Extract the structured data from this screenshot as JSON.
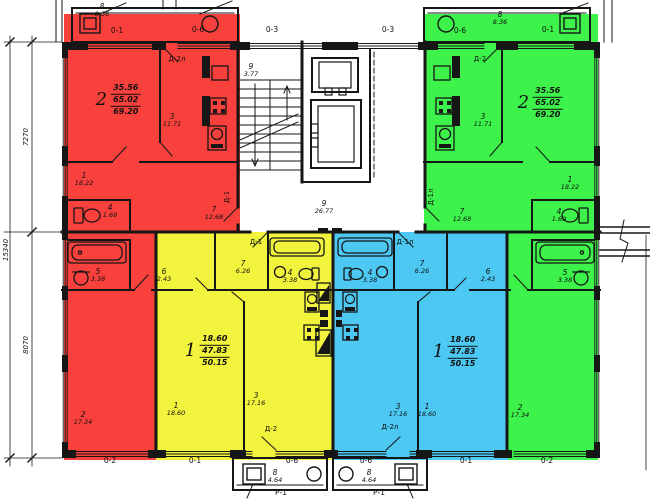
{
  "colors": {
    "red": "#f8403c",
    "yellow": "#f1f33c",
    "blue": "#4cc8f2",
    "green": "#3df24a"
  },
  "apartments": [
    {
      "id": "apartment-2-left",
      "highlight": "red",
      "number": "2",
      "living_area": "35.56",
      "total_area": "65.02",
      "overall_area": "69.20"
    },
    {
      "id": "apartment-2-right",
      "highlight": "green",
      "number": "2",
      "living_area": "35.56",
      "total_area": "65.02",
      "overall_area": "69.20"
    },
    {
      "id": "apartment-1-left",
      "highlight": "yellow",
      "number": "1",
      "living_area": "18.60",
      "total_area": "47.83",
      "overall_area": "50.15"
    },
    {
      "id": "apartment-1-right",
      "highlight": "blue",
      "number": "1",
      "living_area": "18.60",
      "total_area": "47.83",
      "overall_area": "50.15"
    }
  ],
  "labels": [
    {
      "name": "axis-0-1-top-left",
      "cls": "axis",
      "x": 117,
      "y": 31,
      "lines": [
        "0-1"
      ]
    },
    {
      "name": "axis-0-6-top-left",
      "cls": "axis",
      "x": 198,
      "y": 30,
      "lines": [
        "0-6"
      ]
    },
    {
      "name": "axis-0-3-top-center-l",
      "cls": "axis",
      "x": 272,
      "y": 30,
      "lines": [
        "0-3"
      ]
    },
    {
      "name": "axis-0-3-top-center-r",
      "cls": "axis",
      "x": 388,
      "y": 30,
      "lines": [
        "0-3"
      ]
    },
    {
      "name": "axis-0-6-top-right",
      "cls": "axis",
      "x": 460,
      "y": 31,
      "lines": [
        "0-6"
      ]
    },
    {
      "name": "axis-0-1-top-right",
      "cls": "axis",
      "x": 548,
      "y": 30,
      "lines": [
        "0-1"
      ]
    },
    {
      "name": "axis-0-2-bottom-left",
      "cls": "axis",
      "x": 110,
      "y": 461,
      "lines": [
        "0-2"
      ]
    },
    {
      "name": "axis-0-1-bottom-left",
      "cls": "axis",
      "x": 195,
      "y": 461,
      "lines": [
        "0-1"
      ]
    },
    {
      "name": "axis-0-6-bottom-left",
      "cls": "axis",
      "x": 292,
      "y": 461,
      "lines": [
        "0-6"
      ]
    },
    {
      "name": "axis-0-6-bottom-right",
      "cls": "axis",
      "x": 366,
      "y": 461,
      "lines": [
        "0-6"
      ]
    },
    {
      "name": "axis-0-1-bottom-right",
      "cls": "axis",
      "x": 466,
      "y": 461,
      "lines": [
        "0-1"
      ]
    },
    {
      "name": "axis-0-2-bottom-right",
      "cls": "axis",
      "x": 547,
      "y": 461,
      "lines": [
        "0-2"
      ]
    },
    {
      "name": "door-d2l-top-left",
      "cls": "door",
      "x": 177,
      "y": 60,
      "lines": [
        "Д-2л"
      ]
    },
    {
      "name": "door-d2-top-right",
      "cls": "door",
      "x": 480,
      "y": 60,
      "lines": [
        "Д-2"
      ]
    },
    {
      "name": "door-d1-corridor-left",
      "cls": "door",
      "x": 256,
      "y": 243,
      "lines": [
        "Д-1"
      ]
    },
    {
      "name": "door-d1l-corridor-right",
      "cls": "door",
      "x": 405,
      "y": 243,
      "lines": [
        "Д-1л"
      ]
    },
    {
      "name": "door-d1-left-vertical",
      "cls": "door",
      "x": 228,
      "y": 197,
      "rot": -90,
      "lines": [
        "Д-1"
      ]
    },
    {
      "name": "door-d1l-right-vertical",
      "cls": "door",
      "x": 432,
      "y": 197,
      "rot": -90,
      "lines": [
        "Д-1л"
      ]
    },
    {
      "name": "door-d2-bottom-left",
      "cls": "door",
      "x": 271,
      "y": 430,
      "lines": [
        "Д-2"
      ]
    },
    {
      "name": "door-d2l-bottom-right",
      "cls": "door",
      "x": 390,
      "y": 428,
      "lines": [
        "Д-2л"
      ]
    },
    {
      "name": "dim-7270",
      "cls": "dim",
      "x": 27,
      "y": 137,
      "rot": -90,
      "lines": [
        "7270"
      ]
    },
    {
      "name": "dim-15340",
      "cls": "dim",
      "x": 7,
      "y": 250,
      "rot": -90,
      "lines": [
        "15340"
      ]
    },
    {
      "name": "dim-8070",
      "cls": "dim",
      "x": 27,
      "y": 345,
      "rot": -90,
      "lines": [
        "8070"
      ]
    },
    {
      "name": "room-red-1",
      "cls": "room",
      "x": 84,
      "y": 180,
      "lines": [
        "1",
        "18.22"
      ]
    },
    {
      "name": "room-red-3",
      "cls": "room",
      "x": 172,
      "y": 121,
      "lines": [
        "3",
        "11.71"
      ]
    },
    {
      "name": "room-red-4",
      "cls": "room",
      "x": 110,
      "y": 212,
      "lines": [
        "4",
        "1.69"
      ]
    },
    {
      "name": "room-red-5",
      "cls": "room",
      "x": 98,
      "y": 276,
      "lines": [
        "5",
        "3.38"
      ]
    },
    {
      "name": "room-red-7",
      "cls": "room",
      "x": 214,
      "y": 214,
      "lines": [
        "7",
        "12.68"
      ]
    },
    {
      "name": "room-red-2",
      "cls": "room",
      "x": 83,
      "y": 419,
      "lines": [
        "2",
        "17.34"
      ]
    },
    {
      "name": "room-green-1",
      "cls": "room",
      "x": 570,
      "y": 184,
      "lines": [
        "1",
        "18.22"
      ]
    },
    {
      "name": "room-green-3",
      "cls": "room",
      "x": 483,
      "y": 121,
      "lines": [
        "3",
        "11.71"
      ]
    },
    {
      "name": "room-green-4",
      "cls": "room",
      "x": 559,
      "y": 216,
      "lines": [
        "4",
        "1.69"
      ]
    },
    {
      "name": "room-green-5",
      "cls": "room",
      "x": 565,
      "y": 277,
      "lines": [
        "5",
        "3.38"
      ]
    },
    {
      "name": "room-green-7",
      "cls": "room",
      "x": 462,
      "y": 216,
      "lines": [
        "7",
        "12.68"
      ]
    },
    {
      "name": "room-green-2",
      "cls": "room",
      "x": 520,
      "y": 412,
      "lines": [
        "2",
        "17.34"
      ]
    },
    {
      "name": "room-yellow-6",
      "cls": "room",
      "x": 164,
      "y": 276,
      "lines": [
        "6",
        "2.43"
      ]
    },
    {
      "name": "room-yellow-7",
      "cls": "room",
      "x": 243,
      "y": 268,
      "lines": [
        "7",
        "6.26"
      ]
    },
    {
      "name": "room-yellow-4",
      "cls": "room",
      "x": 290,
      "y": 277,
      "lines": [
        "4",
        "3.38"
      ]
    },
    {
      "name": "room-yellow-1",
      "cls": "room",
      "x": 176,
      "y": 410,
      "lines": [
        "1",
        "18.60"
      ]
    },
    {
      "name": "room-yellow-3",
      "cls": "room",
      "x": 256,
      "y": 400,
      "lines": [
        "3",
        "17.16"
      ]
    },
    {
      "name": "room-blue-6",
      "cls": "room",
      "x": 488,
      "y": 276,
      "lines": [
        "6",
        "2.43"
      ]
    },
    {
      "name": "room-blue-7",
      "cls": "room",
      "x": 422,
      "y": 268,
      "lines": [
        "7",
        "6.26"
      ]
    },
    {
      "name": "room-blue-4",
      "cls": "room",
      "x": 370,
      "y": 277,
      "lines": [
        "4",
        "3.38"
      ]
    },
    {
      "name": "room-blue-1",
      "cls": "room",
      "x": 427,
      "y": 411,
      "lines": [
        "1",
        "18.60"
      ]
    },
    {
      "name": "room-blue-3",
      "cls": "room",
      "x": 398,
      "y": 411,
      "lines": [
        "3",
        "17.16"
      ]
    },
    {
      "name": "room-staircase",
      "cls": "room",
      "x": 251,
      "y": 71,
      "lines": [
        "9",
        "3.77"
      ]
    },
    {
      "name": "room-corridor",
      "cls": "room",
      "x": 324,
      "y": 208,
      "lines": [
        "9",
        "26.77"
      ]
    },
    {
      "name": "balcony-top-left",
      "cls": "balc",
      "x": 102,
      "y": 11,
      "lines": [
        "8",
        "8.36"
      ]
    },
    {
      "name": "balcony-top-right",
      "cls": "balc",
      "x": 500,
      "y": 19,
      "lines": [
        "8",
        "8.36"
      ]
    },
    {
      "name": "balcony-bottom-left",
      "cls": "balc",
      "x": 275,
      "y": 477,
      "lines": [
        "8",
        "4.64"
      ]
    },
    {
      "name": "balcony-bottom-right",
      "cls": "balc",
      "x": 369,
      "y": 477,
      "lines": [
        "8",
        "4.64"
      ]
    },
    {
      "name": "entrance-r1-left",
      "cls": "axis",
      "x": 281,
      "y": 493,
      "lines": [
        "Р-1"
      ]
    },
    {
      "name": "entrance-r1-right",
      "cls": "axis",
      "x": 379,
      "y": 493,
      "lines": [
        "Р-1"
      ]
    }
  ]
}
